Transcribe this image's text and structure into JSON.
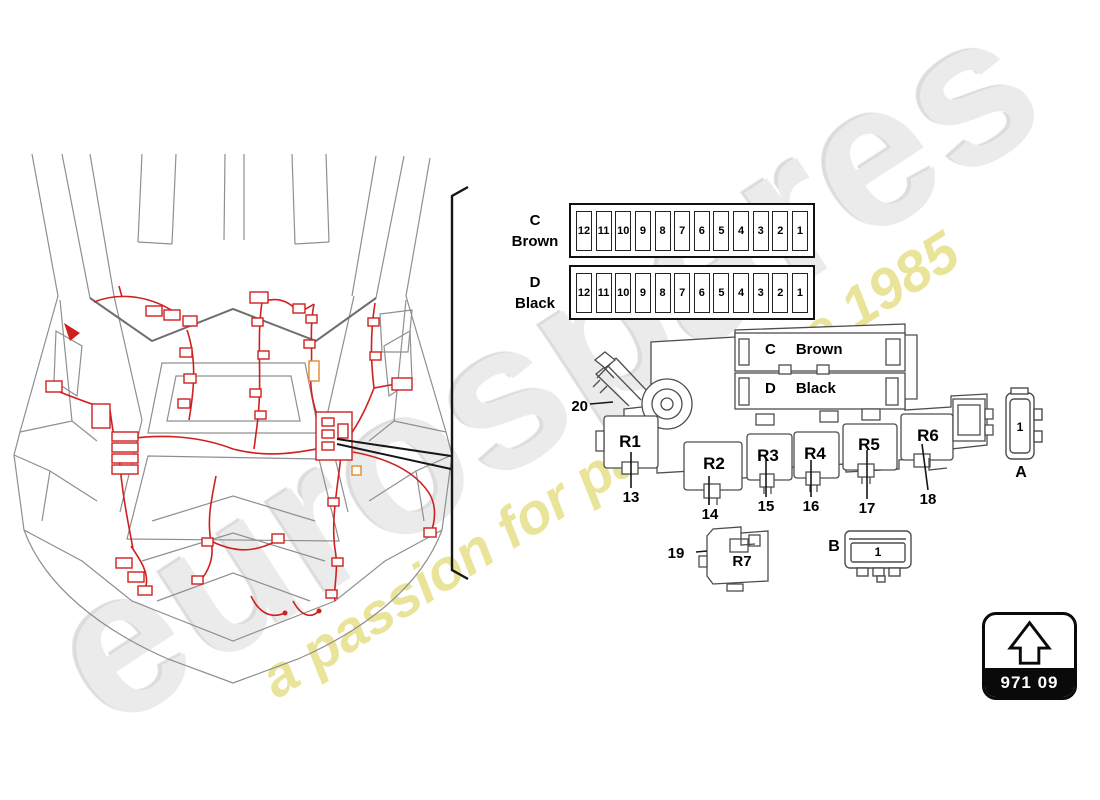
{
  "watermark": {
    "brand": "eurospares",
    "tagline": "a passion for parts since 1985"
  },
  "strips": {
    "c": {
      "letter": "C",
      "color": "Brown",
      "fuses": [
        "12",
        "11",
        "10",
        "9",
        "8",
        "7",
        "6",
        "5",
        "4",
        "3",
        "2",
        "1"
      ]
    },
    "d": {
      "letter": "D",
      "color": "Black",
      "fuses": [
        "12",
        "11",
        "10",
        "9",
        "8",
        "7",
        "6",
        "5",
        "4",
        "3",
        "2",
        "1"
      ]
    }
  },
  "fusebox": {
    "bar_c_letter": "C",
    "bar_c_color": "Brown",
    "bar_d_letter": "D",
    "bar_d_color": "Black",
    "relays": {
      "r1": "R1",
      "r2": "R2",
      "r3": "R3",
      "r4": "R4",
      "r5": "R5",
      "r6": "R6",
      "r7": "R7"
    },
    "callouts": {
      "n13": "13",
      "n14": "14",
      "n15": "15",
      "n16": "16",
      "n17": "17",
      "n18": "18",
      "n19": "19",
      "n20": "20"
    }
  },
  "connectors": {
    "a": {
      "label": "A",
      "pin": "1"
    },
    "b": {
      "label": "B",
      "pin": "1"
    }
  },
  "badge": {
    "part_code": "971 09"
  },
  "colors": {
    "harness_red": "#cf2020",
    "connector_orange": "#e08a30",
    "tagline_yellow": "#e9e396",
    "car_line_gray": "#8f8f8f",
    "drawing_gray": "#4d4d4d",
    "callout_black": "#161616"
  }
}
